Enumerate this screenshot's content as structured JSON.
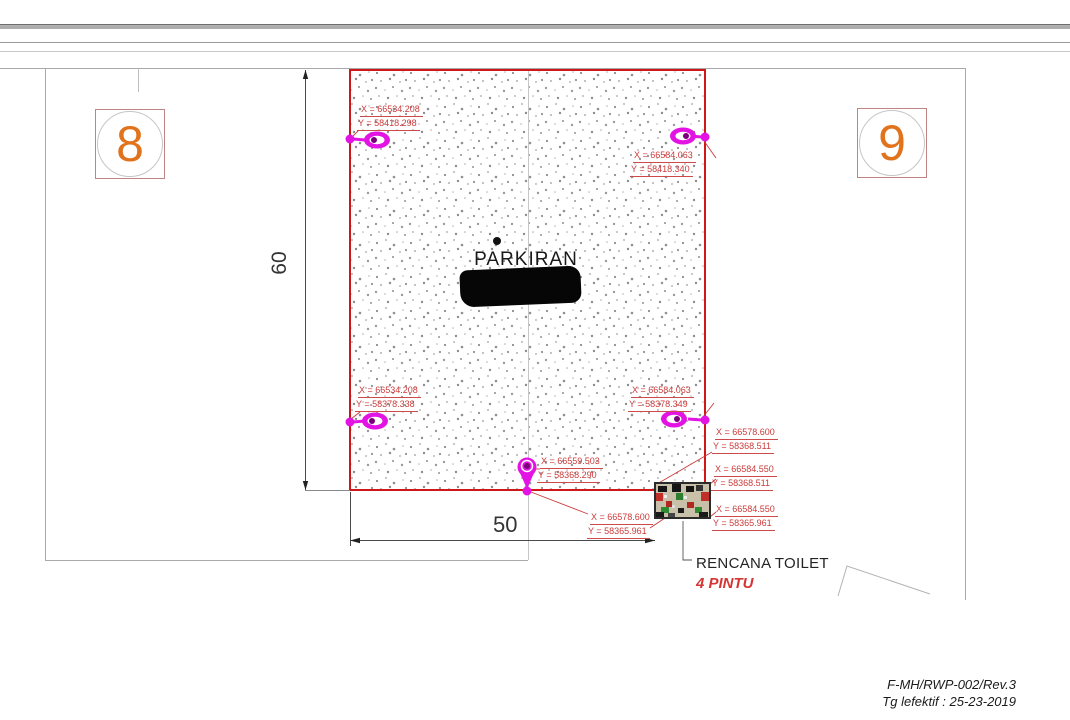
{
  "sheet": {
    "area_label": "PARKIRAN",
    "parcel_left": "8",
    "parcel_right": "9",
    "dim_height": "60",
    "dim_width": "50",
    "toilet_title": "RENCANA TOILET",
    "toilet_subtitle": "4 PINTU"
  },
  "coordinates": [
    {
      "point": "parking-top-left",
      "x": "X = 66534.208",
      "y": "Y = 58418.298"
    },
    {
      "point": "parking-top-right",
      "x": "X = 66584.063",
      "y": "Y = 58418.340"
    },
    {
      "point": "parking-bottom-left",
      "x": "X = 66534.208",
      "y": "Y = 58378.338"
    },
    {
      "point": "parking-bottom-right",
      "x": "X = 66584.063",
      "y": "Y = 58378.349"
    },
    {
      "point": "parking-bottom-center",
      "x": "X = 66559.503",
      "y": "Y = 58368.290"
    },
    {
      "point": "toilet-top-left",
      "x": "X = 66578.600",
      "y": "Y = 58368.511"
    },
    {
      "point": "toilet-top-right",
      "x": "X = 66584.550",
      "y": "Y = 58368.511"
    },
    {
      "point": "toilet-bottom-right",
      "x": "X = 66584.550",
      "y": "Y = 58365.961"
    },
    {
      "point": "toilet-bottom-left",
      "x": "X = 66578.600",
      "y": "Y = 58365.961"
    }
  ],
  "footer": {
    "doc_code": "F-MH/RWP-002/Rev.3",
    "effective_date": "Tg lefektif : 25-23-2019"
  },
  "colors": {
    "boundary_red": "#cf1717",
    "annotation_red": "#cc3a3a",
    "marker_magenta": "#e313e3",
    "parcel_number_orange": "#e2731d"
  }
}
